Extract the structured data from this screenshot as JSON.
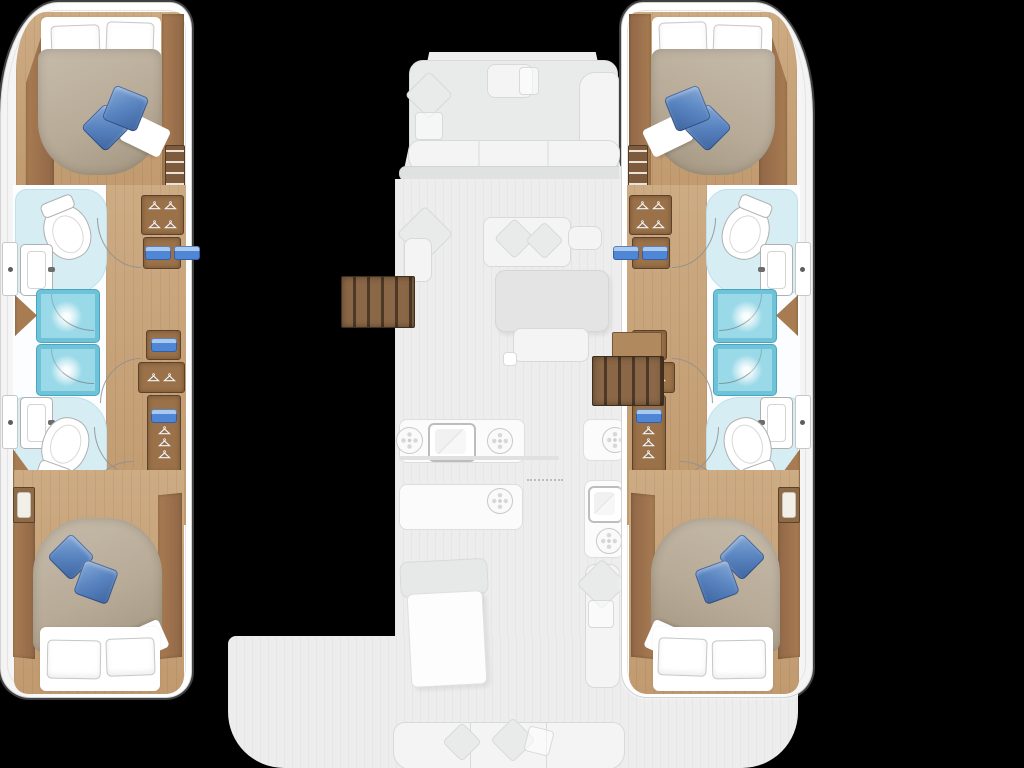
{
  "meta": {
    "description": "Top-down interior floor plan of a sailing catamaran, 4-cabin / 4-bathroom layout; hull interiors rendered in full colour, bridge-deck saloon, galley, bow lounge and aft cockpit shown ghosted pale grey on a black background",
    "visible_text": []
  },
  "colors": {
    "bg": "#000000",
    "hull": "#ffffff",
    "hullLine": "#d4d4d4",
    "deck": "#ededed",
    "deckEdge": "#e0e2e2",
    "ghost": "#f4f4f4",
    "ghostFill": "#e9eaea",
    "ghostLine": "#d8dada",
    "wood": "#c7a67e",
    "woodDark": "#a87c52",
    "cabinet": "#9a7148",
    "cabinetLine": "#5c412b",
    "stairsGap": "#4e3926",
    "bedTan": "#b8ab98",
    "bedTanDark": "#a2957f",
    "pillowBlue": "#5c87c2",
    "pillowBlueLight": "#88abd8",
    "pillowBlueDark": "#3d64a0",
    "bathFloor": "#d6edf4",
    "showerFill": "#9ad9e8",
    "showerEdge": "#6fc3d8",
    "showerLine": "#4aa6c0",
    "towel": "#4f86d6",
    "towelLight": "#a9c9ee",
    "fixtureLine": "#b0b0b0",
    "arcLine": "#8f8f8f"
  },
  "vessel": {
    "type": "catamaran",
    "layout": "4 double cabins, 4 bathrooms, 4 showers",
    "hulls": [
      {
        "side": "port",
        "rooms": [
          "forward double cabin",
          "forward bathroom with toilet and sink",
          "two shower stalls",
          "aft bathroom with toilet and sink",
          "aft double cabin",
          "corridor with wardrobes and companionway stairs"
        ]
      },
      {
        "side": "starboard",
        "rooms": [
          "forward double cabin",
          "forward bathroom with toilet and sink",
          "two shower stalls",
          "aft bathroom with toilet and sink",
          "aft double cabin",
          "corridor with wardrobes and companionway stairs"
        ]
      }
    ],
    "deck_ghosted": [
      "bow lounge with cushions",
      "saloon sofa and table",
      "galley counters with sink and burners",
      "aft cockpit with table and bench seating"
    ]
  },
  "icons": [
    "toilet-icon",
    "sink-icon",
    "shower-spray-icon",
    "hanger-icon",
    "towel-icon",
    "burner-icon",
    "porthole-icon",
    "door-swing-arc",
    "stairs-icon",
    "pillow-icon"
  ]
}
